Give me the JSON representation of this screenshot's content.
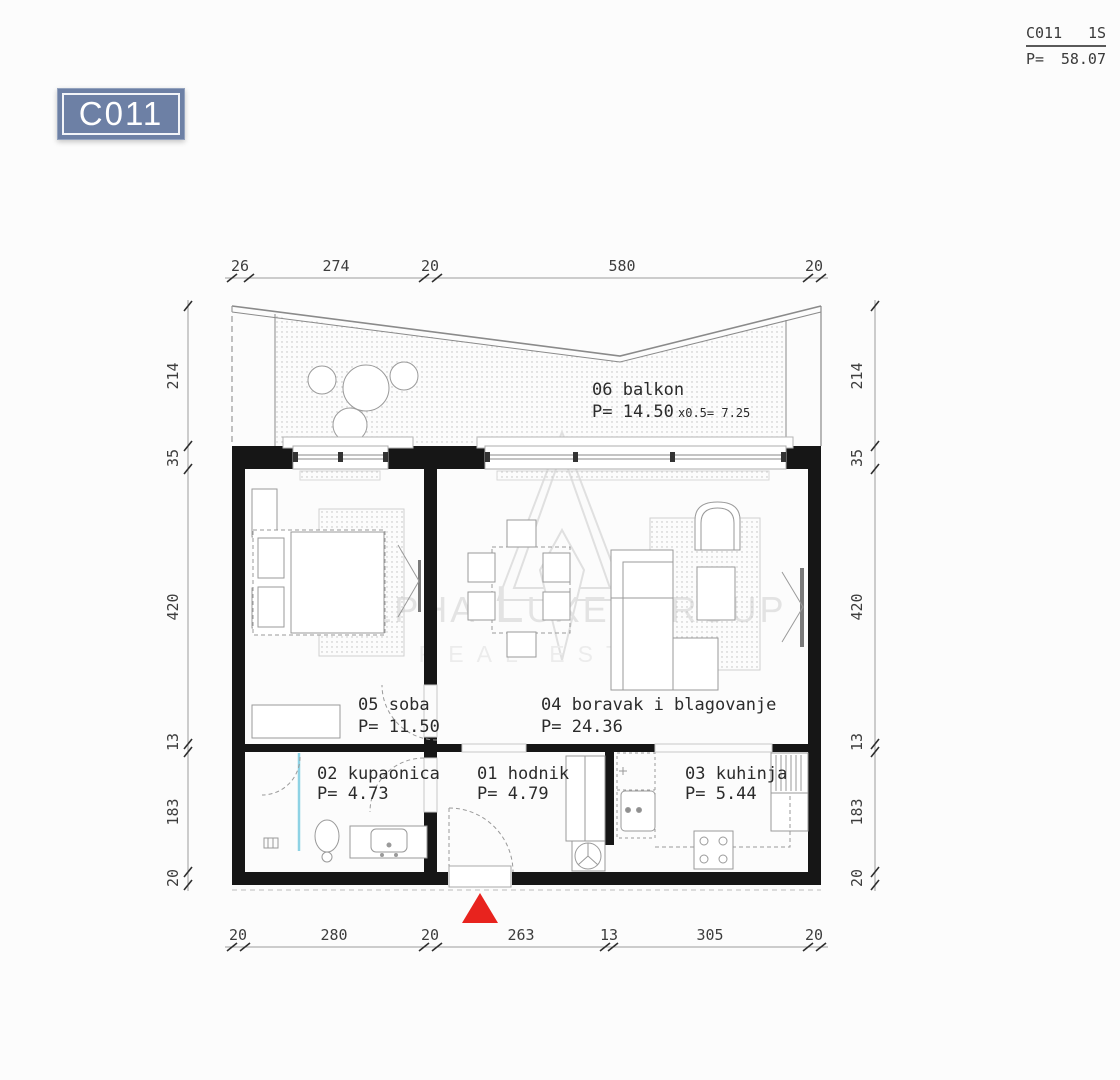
{
  "sheet_header": {
    "unit": "C011",
    "type": "1S",
    "area_prefix": "P=",
    "area": "58.07"
  },
  "badge": {
    "label": "C011"
  },
  "rooms": {
    "balkon": {
      "id_name": "06 balkon",
      "area": "P= 14.50",
      "area_note": "x0.5=  7.25"
    },
    "soba": {
      "id_name": "05 soba",
      "area": "P= 11.50"
    },
    "boravak": {
      "id_name": "04 boravak i blagovanje",
      "area": "P= 24.36"
    },
    "kupaonica": {
      "id_name": "02 kupaonica",
      "area": "P= 4.73"
    },
    "hodnik": {
      "id_name": "01 hodnik",
      "area": "P= 4.79"
    },
    "kuhinja": {
      "id_name": "03 kuhinja",
      "area": "P= 5.44"
    }
  },
  "dimensions": {
    "top": [
      "26",
      "274",
      "20",
      "580",
      "20"
    ],
    "bottom": [
      "20",
      "280",
      "20",
      "263",
      "13",
      "305",
      "20"
    ],
    "left": [
      "214",
      "35",
      "420",
      "13",
      "183",
      "20"
    ],
    "right": [
      "214",
      "35",
      "420",
      "13",
      "183",
      "20"
    ]
  },
  "watermark": {
    "line1": "Alpha Luxe Group",
    "line2": "REAL ESTATE"
  },
  "colors": {
    "badge_blue": "#6d80a5",
    "wall_black": "#161616",
    "entrance_red": "#e8231e",
    "shower_cyan": "#8ed2e4"
  }
}
